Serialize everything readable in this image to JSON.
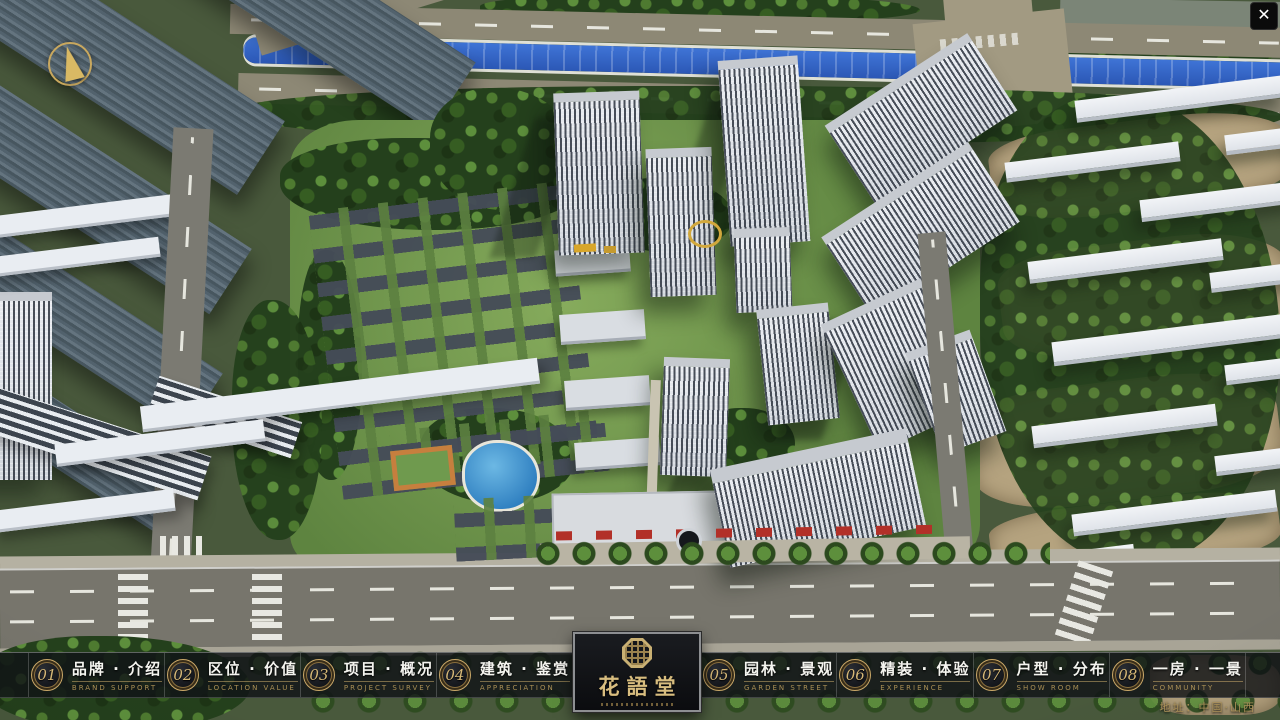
{
  "app": {
    "close_glyph": "✕"
  },
  "theme": {
    "gold_accent": "#c9a96a",
    "bar_background": "rgba(16,18,22,0.82)",
    "river_blue": "#2f63c4",
    "label_white": "#f4f4ef"
  },
  "navbar": {
    "items": [
      {
        "num": "01",
        "label": "品牌 · 介绍",
        "sub": "BRAND SUPPORT"
      },
      {
        "num": "02",
        "label": "区位 · 价值",
        "sub": "LOCATION VALUE"
      },
      {
        "num": "03",
        "label": "项目 · 概况",
        "sub": "PROJECT SURVEY"
      },
      {
        "num": "04",
        "label": "建筑 · 鉴赏",
        "sub": "APPRECIATION"
      },
      {
        "num": "05",
        "label": "园林 · 景观",
        "sub": "GARDEN STREET"
      },
      {
        "num": "06",
        "label": "精装 · 体验",
        "sub": "EXPERIENCE"
      },
      {
        "num": "07",
        "label": "户型 · 分布",
        "sub": "SHOW ROOM"
      },
      {
        "num": "08",
        "label": "一房 · 一景",
        "sub": "COMMUNITY"
      }
    ]
  },
  "logo": {
    "title": "花語堂"
  },
  "footer": {
    "address": "地址：中国·山西"
  }
}
